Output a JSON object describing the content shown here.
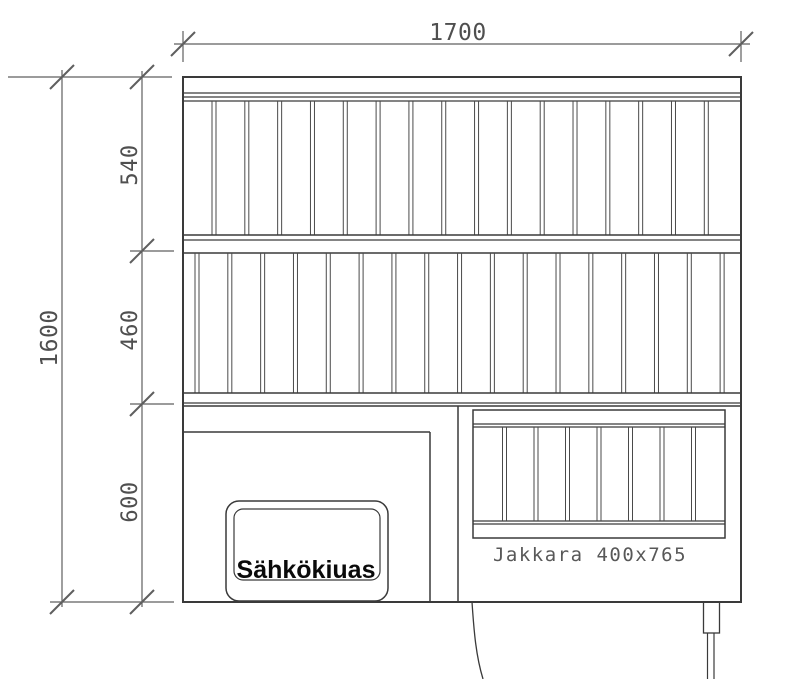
{
  "drawing": {
    "dimensions": {
      "total_width": "1700",
      "total_height": "1600",
      "segments": [
        "540",
        "460",
        "600"
      ]
    },
    "labels": {
      "heater": "Sähkökiuas",
      "stool": "Jakkara 400x765"
    },
    "structure": {
      "top_section_slat_dividers": 16,
      "middle_section_slat_dividers": 17,
      "stool_slat_dividers": 7
    },
    "colors": {
      "line": "#3a3a3a",
      "slat": "#4a4a4a",
      "dimension": "#5f5f5f",
      "text": "#4f4f4f",
      "heater_text": "#0a0a0a",
      "background": "#ffffff"
    }
  }
}
